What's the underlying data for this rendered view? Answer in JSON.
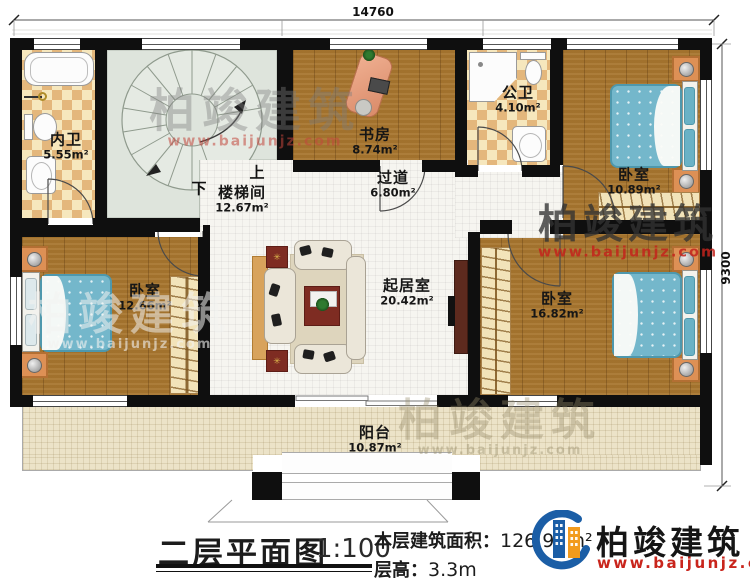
{
  "dimensions": {
    "top": "14760",
    "right": "9300"
  },
  "rooms": {
    "neiwei": {
      "name": "内卫",
      "area": "5.55m²"
    },
    "loutijian": {
      "name": "楼梯间",
      "area": "12.67m²"
    },
    "shufang": {
      "name": "书房",
      "area": "8.74m²"
    },
    "gongwei": {
      "name": "公卫",
      "area": "4.10m²"
    },
    "woshi1": {
      "name": "卧室",
      "area": "10.89m²"
    },
    "guodao": {
      "name": "过道",
      "area": "6.80m²"
    },
    "qijushi": {
      "name": "起居室",
      "area": "20.42m²"
    },
    "woshi2": {
      "name": "卧室",
      "area": "12.66m²"
    },
    "woshi3": {
      "name": "卧室",
      "area": "16.82m²"
    },
    "yangtai": {
      "name": "阳台",
      "area": "10.87m²"
    }
  },
  "stairs": {
    "up": "上",
    "down": "下"
  },
  "title_block": {
    "plan_title": "二层平面图",
    "scale": "1:100",
    "area_label": "本层建筑面积：",
    "area_value": "126.97m²",
    "floor_height_label": "层高：",
    "floor_height_value": "3.3m"
  },
  "brand": {
    "name": "柏竣建筑",
    "url": "www.baijunjz.com"
  },
  "colors": {
    "wall": "#0f0f0f",
    "wood_floor": "#a8762f",
    "tile_dark": "#e4b77c",
    "tile_light": "#f6e7bd",
    "stair_floor": "#dee4dc",
    "balcony_floor": "#ece3c8",
    "bed": "#74b7cb",
    "brand_red": "#c9251c",
    "brand_blue": "#1b5ea6",
    "brand_orange": "#f29b1d"
  }
}
